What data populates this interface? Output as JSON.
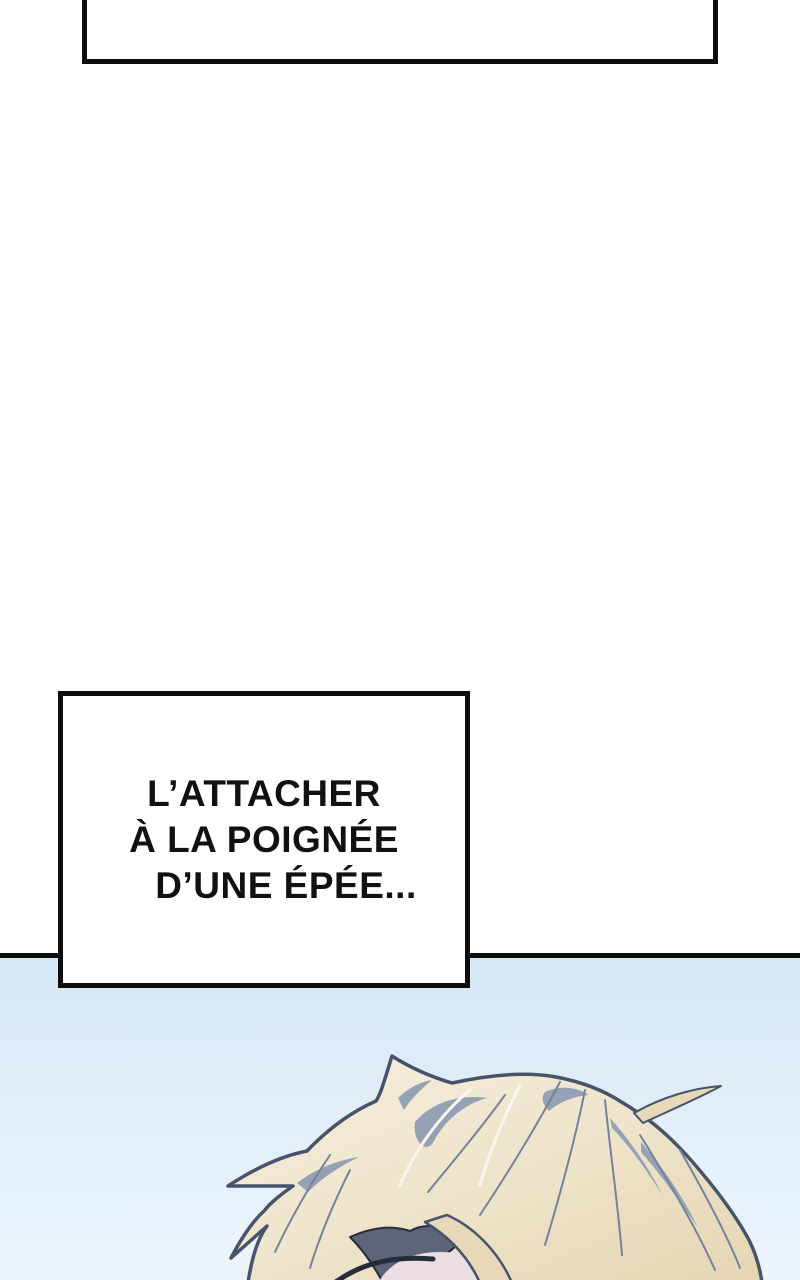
{
  "speech_box": {
    "lines": [
      "L’ATTACHER",
      "À LA POIGNÉE",
      "D’UNE ÉPÉE..."
    ]
  },
  "illustration": {
    "name": "blonde-character-head-top",
    "subject": "top of a blonde-haired character's head, eyes closed, against light blue sky"
  },
  "colors": {
    "panel_border": "#0e0e0e",
    "speech_text": "#111111",
    "sky_top": "#d6e8f6",
    "sky_bottom": "#edf5fc",
    "hair_light": "#f6efdf",
    "hair_tan": "#e7d8b8",
    "hair_shade": "#95a1b4",
    "hair_outline": "#46536b",
    "strand": "#75829a",
    "shadow_dark": "#5d6477",
    "eye_dark": "#262c3a",
    "skin": "#ebdfe3",
    "highlight": "#fbf7ee"
  }
}
